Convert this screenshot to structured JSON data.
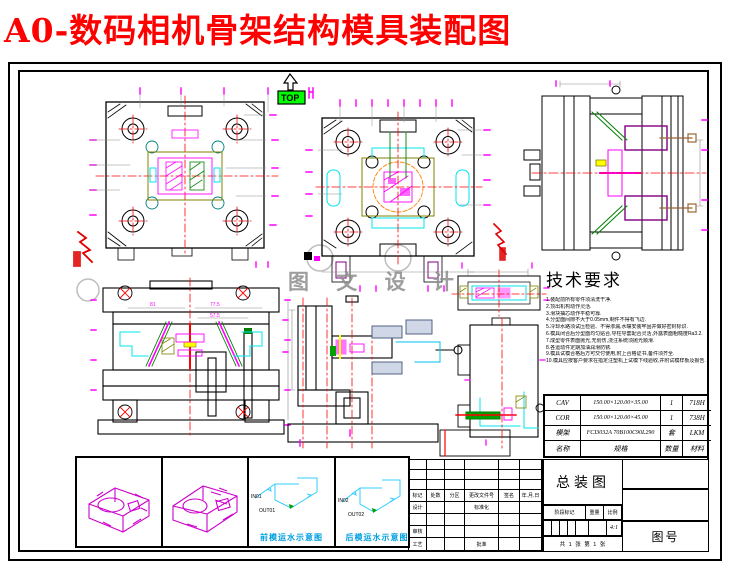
{
  "title": "A0-数码相机骨架结构模具装配图",
  "top_marker": {
    "label": "TOP"
  },
  "watermark": {
    "text": "图 文 设 计"
  },
  "tech": {
    "title": "技术要求",
    "lines": [
      "1.装配前所有零件须清洗干净.",
      "2.顶出机构动作灵活.",
      "3.滑块抽芯动作平稳可靠.",
      "4.分型面间隙不大于0.05mm,制件不得有飞边.",
      "5.冷却水路须试压检验、不得渗漏,水嘴安装牢固并做好密封标识.",
      "6.模具闭合后分型面均匀贴合,导柱导套配合灵活,外露表面粗糙度Ra3.2.",
      "7.成型零件表面抛光,无划伤,浇注系统须抛光顺滑.",
      "8.各运动件定期加油润滑防锈.",
      "9.模具试模合格后方可交付使用,附上合格证书,备件须齐全.",
      "10.模具应按客户要求在指定注塑机上试模下线验收,并附试模样板及报告."
    ]
  },
  "mold_table": {
    "rows": [
      {
        "c1": "CAV",
        "c2": "150.00×120.00×35.00",
        "c3": "1",
        "c4": "718H"
      },
      {
        "c1": "COR",
        "c2": "150.00×120.00×45.00",
        "c3": "1",
        "c4": "738H"
      },
      {
        "c1": "模架",
        "c2": "FCI3032A 70B100C90L290",
        "c3": "套",
        "c4": "LKM"
      },
      {
        "c1": "名称",
        "c2": "规格",
        "c3": "数量",
        "c4": "材料"
      }
    ]
  },
  "title_block": {
    "drawing_name": "总装图",
    "drawing_no_label": "图号",
    "rev_headers": [
      "标记",
      "处数",
      "分区",
      "更改文件号",
      "签名",
      "年.月.日"
    ],
    "design_label": "设计",
    "standard_label": "标准化",
    "check_label": "审核",
    "process_label": "工艺",
    "approve_label": "批准",
    "stage_label": "阶段标记",
    "weight_label": "重量",
    "scale_label": "比例",
    "scale_value": "4:1",
    "sheet_info": "共 1 张 第 1 张"
  },
  "cooling": {
    "front": {
      "in": "IN01",
      "out": "OUT01",
      "caption": "前模运水示意图"
    },
    "rear": {
      "in": "IN02",
      "out": "OUT02",
      "caption": "后模运水示意图"
    }
  },
  "dims": {
    "d1": "81",
    "d2": "77.5",
    "d3": "57.5"
  },
  "colors": {
    "title_red": "#ff0000",
    "callout_magenta": "#ff00ff",
    "detail_cyan": "#00ffff",
    "section_green": "#008000",
    "top_marker_green": "#00ff00",
    "caption_blue": "#00a0e0"
  }
}
